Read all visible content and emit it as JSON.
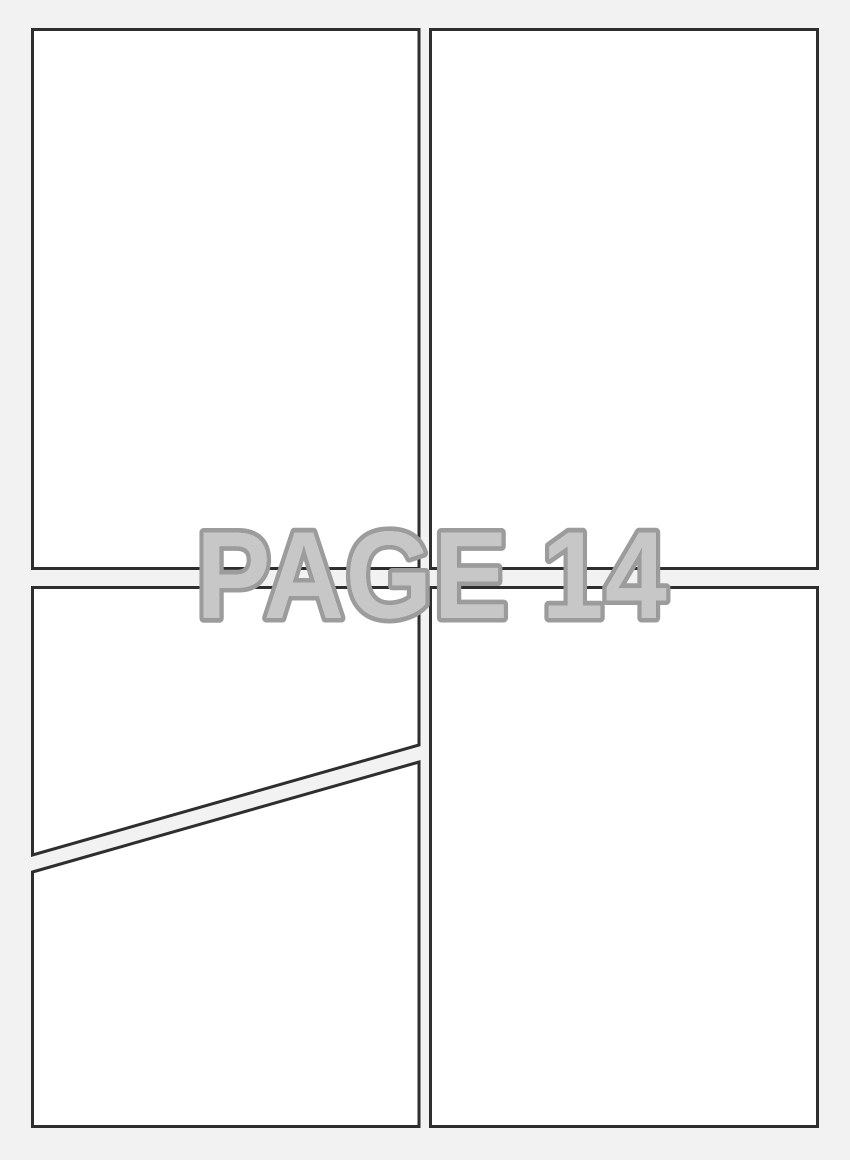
{
  "page": {
    "watermark_label": "PAGE 14"
  },
  "layout_description": {
    "type": "blank-comic-page-template",
    "panel_count": 5,
    "panels": [
      {
        "id": "panel-top-left",
        "shape": "rectangle"
      },
      {
        "id": "panel-top-right",
        "shape": "rectangle"
      },
      {
        "id": "panel-bottom-left-upper",
        "shape": "diagonal-cut-quad"
      },
      {
        "id": "panel-bottom-left-lower",
        "shape": "diagonal-cut-quad"
      },
      {
        "id": "panel-bottom-right",
        "shape": "rectangle"
      }
    ]
  },
  "colors": {
    "background": "#f2f2f2",
    "panel_fill": "#ffffff",
    "panel_border": "#2e2e2e",
    "watermark_stroke": "#9c9c9c",
    "watermark_fill": "rgba(243,243,243,0.82)"
  }
}
